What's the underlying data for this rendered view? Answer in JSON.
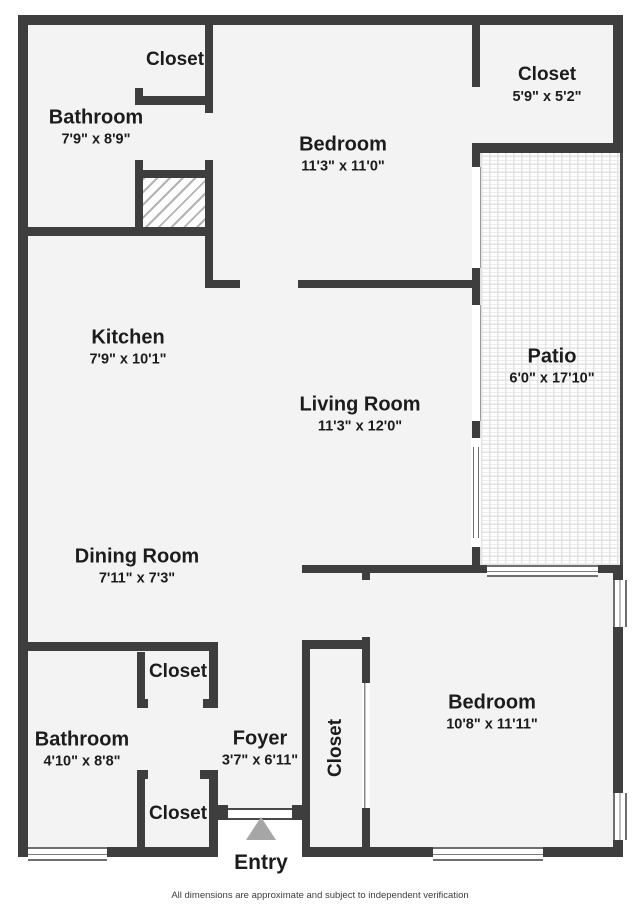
{
  "colors": {
    "wall": "#3e3e3e",
    "floor": "#f3f3f3",
    "outside": "#ffffff",
    "text": "#1c1c1c",
    "entry_arrow": "#a6a6a6",
    "window_line": "#6f6f6f"
  },
  "rooms": {
    "bathroom_top": {
      "name": "Bathroom",
      "dims": "7'9\" x 8'9\""
    },
    "closet_top_left": {
      "name": "Closet"
    },
    "bedroom_top": {
      "name": "Bedroom",
      "dims": "11'3\" x 11'0\""
    },
    "closet_top_right": {
      "name": "Closet",
      "dims": "5'9\" x 5'2\""
    },
    "patio": {
      "name": "Patio",
      "dims": "6'0\" x 17'10\""
    },
    "kitchen": {
      "name": "Kitchen",
      "dims": "7'9\" x 10'1\""
    },
    "living_room": {
      "name": "Living Room",
      "dims": "11'3\" x 12'0\""
    },
    "dining_room": {
      "name": "Dining Room",
      "dims": "7'11\" x 7'3\""
    },
    "bathroom_bottom": {
      "name": "Bathroom",
      "dims": "4'10\" x 8'8\""
    },
    "closet_mid_left": {
      "name": "Closet"
    },
    "closet_bottom_left": {
      "name": "Closet"
    },
    "foyer": {
      "name": "Foyer",
      "dims": "3'7\" x 6'11\""
    },
    "closet_vertical": {
      "name": "Closet"
    },
    "bedroom_bottom": {
      "name": "Bedroom",
      "dims": "10'8\" x 11'11\""
    },
    "entry": {
      "name": "Entry"
    }
  },
  "icons": {
    "entry_arrow": "triangle-up"
  },
  "footer": {
    "disclaimer": "All dimensions are approximate and subject to independent verification"
  }
}
